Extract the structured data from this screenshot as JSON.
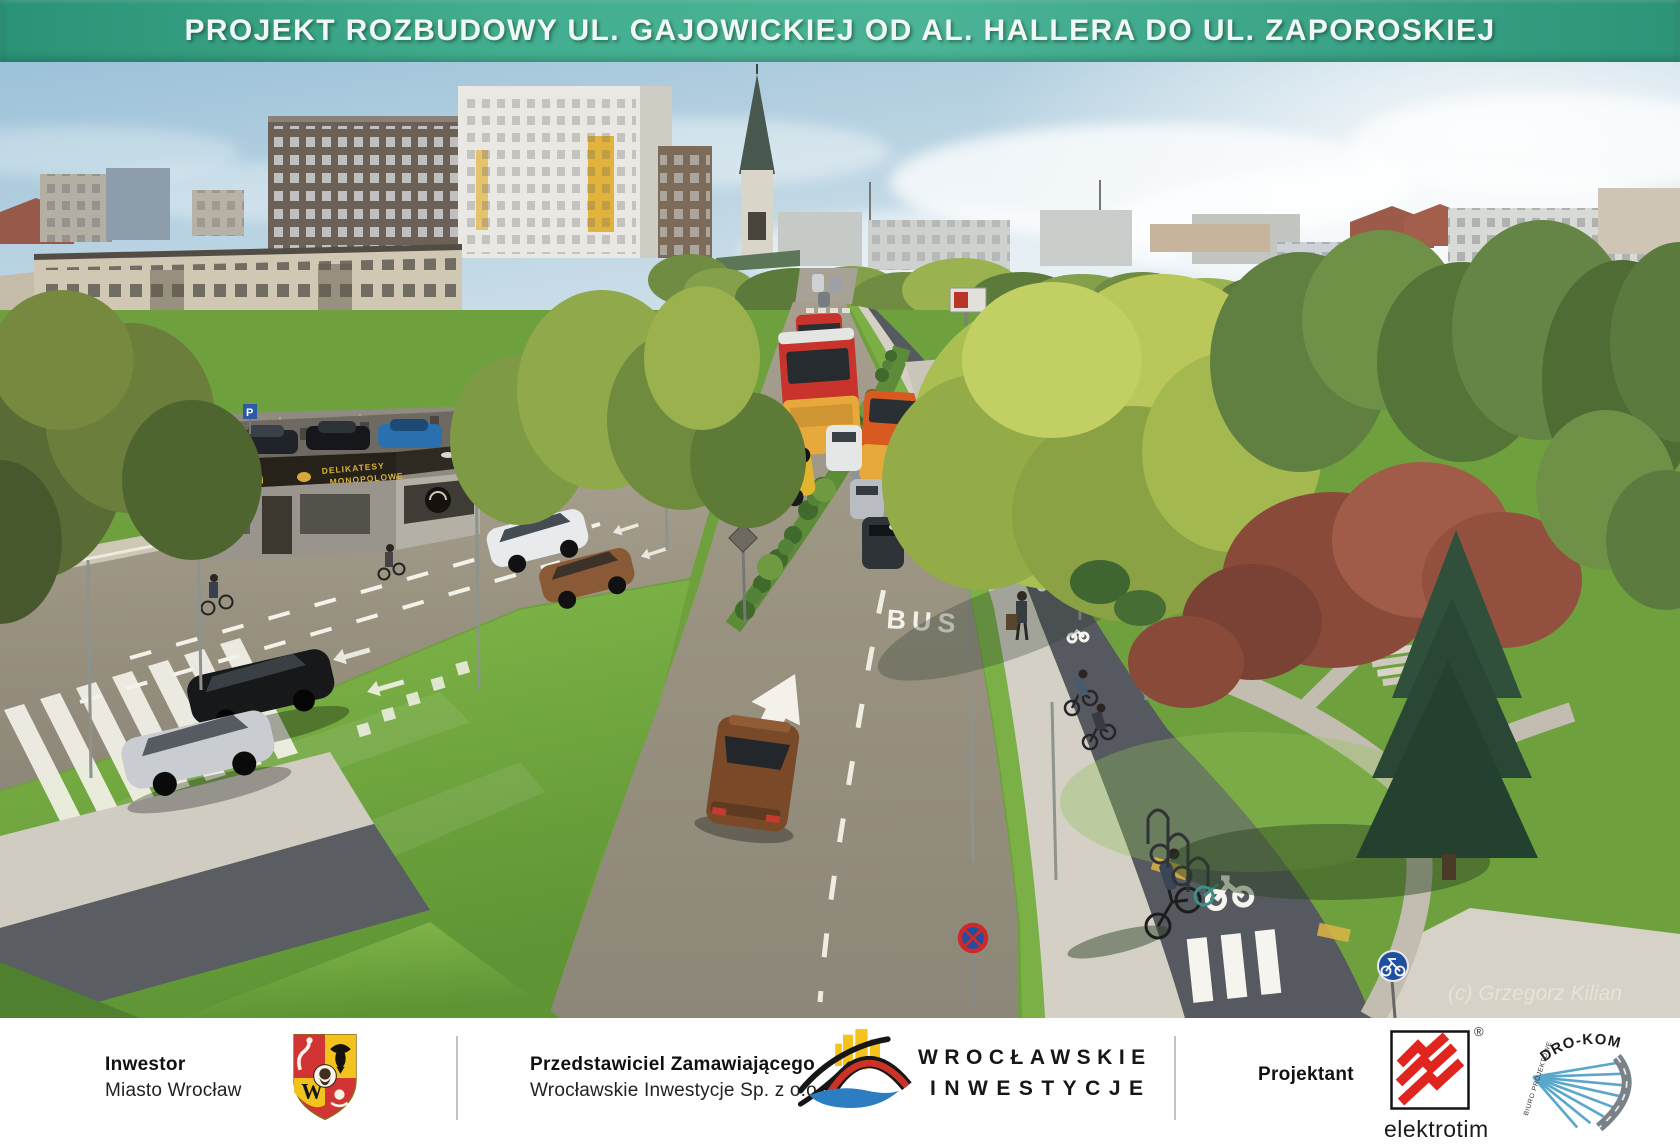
{
  "banner": {
    "title": "PROJEKT ROZBUDOWY UL. GAJOWICKIEJ OD AL. HALLERA DO UL. ZAPOROSKIEJ"
  },
  "scene": {
    "bus_lane_marking": "BUS",
    "kiosk_hours": "24 h",
    "kiosk_line1": "DELIKATESY",
    "kiosk_line2": "MONOPOLOWE",
    "parking_sign": "P",
    "watermark": "(c) Grzegorz Kilian"
  },
  "footer": {
    "investor": {
      "label": "Inwestor",
      "value": "Miasto Wrocław"
    },
    "representative": {
      "label": "Przedstawiciel Zamawiającego",
      "value": "Wrocławskie Inwestycje  Sp. z o.o."
    },
    "wi": {
      "line1": "WROCŁAWSKIE",
      "line2": "INWESTYCJE"
    },
    "designer_label": "Projektant",
    "elektrotim": {
      "name": "elektrotim",
      "reg": "®"
    },
    "drokom": {
      "name": "DRO-KOM",
      "sub": "BIURO PROJEKTOWE"
    },
    "crest_w": "W"
  },
  "colors": {
    "banner_green": "#3aa98b",
    "asphalt": "#9a9386",
    "bike_path": "#565a60",
    "grass": "#76ae3f",
    "sign_blue": "#1f4fa0",
    "elektrotim_red": "#e0251f",
    "wi_yellow": "#f6c31c",
    "wi_red": "#cc3327",
    "wi_blue": "#2c7dc2",
    "drokom_blue": "#5aa7cc"
  }
}
